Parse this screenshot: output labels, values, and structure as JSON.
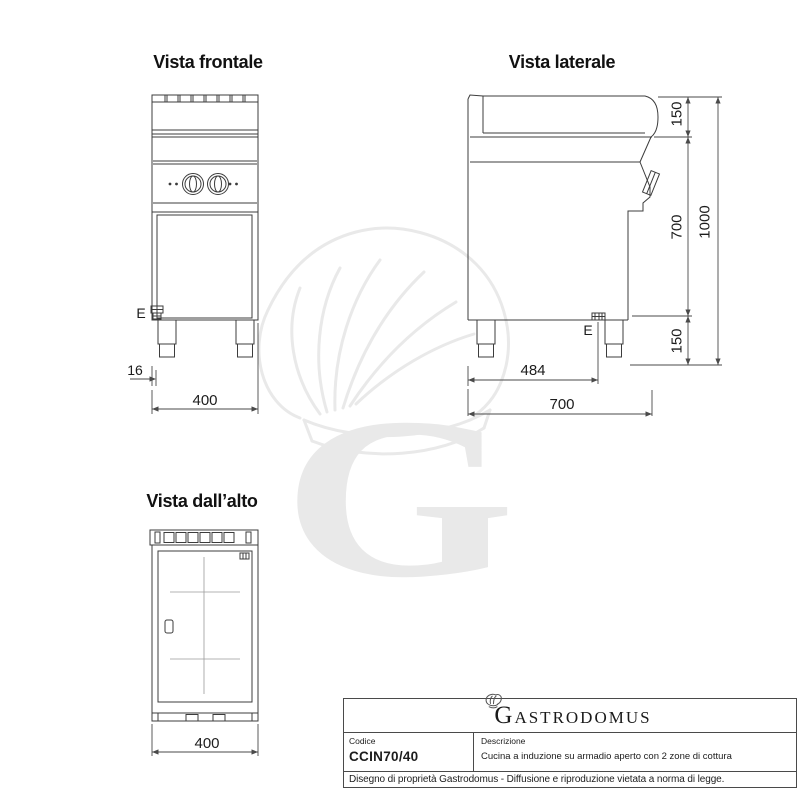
{
  "views": {
    "front": {
      "title": "Vista frontale",
      "e_label": "E",
      "dim_e_offset": "16",
      "dim_width": "400"
    },
    "side": {
      "title": "Vista laterale",
      "e_label": "E",
      "dim_backsplash_height": "150",
      "dim_body_height": "700",
      "dim_leg_height": "150",
      "dim_total_height": "1000",
      "dim_e_offset": "484",
      "dim_depth": "700"
    },
    "top": {
      "title": "Vista dall’alto",
      "dim_width": "400"
    }
  },
  "title_block": {
    "brand_initial": "G",
    "brand_rest": "ASTRODOMUS",
    "code_label": "Codice",
    "code_value": "CCIN70/40",
    "description_label": "Descrizione",
    "description_value": "Cucina a induzione su armadio aperto con 2 zone di cottura",
    "footer": "Disegno di proprietà Gastrodomus - Diffusione e riproduzione vietata a norma di legge."
  },
  "watermark": {
    "letter": "G"
  },
  "colors": {
    "line": "#3c3c3c",
    "dim_line": "#4a4a4a",
    "text": "#1c1c1c",
    "watermark": "#e9e9e9",
    "border": "#4a4a4a"
  }
}
